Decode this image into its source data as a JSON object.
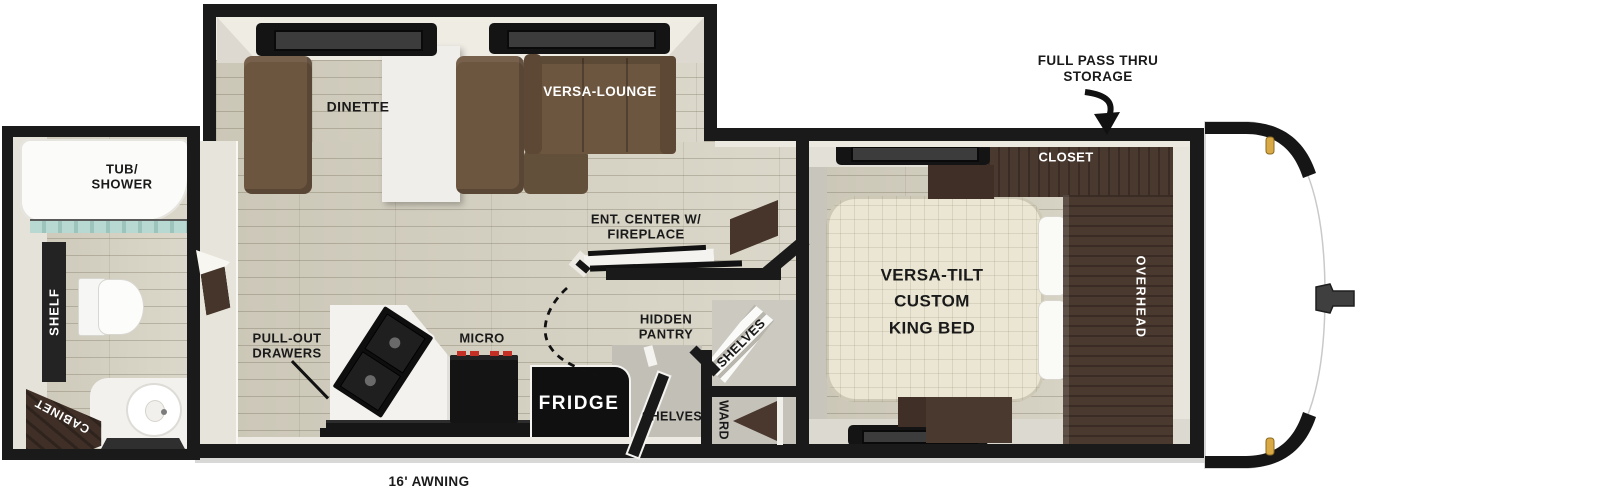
{
  "floorplan": {
    "type": "travel trailer floor plan",
    "awning_label": "16' AWNING",
    "exterior": {
      "storage_line1": "FULL PASS THRU",
      "storage_line2": "STORAGE"
    },
    "bathroom": {
      "tub_line1": "TUB/",
      "tub_line2": "SHOWER",
      "shelf": "SHELF",
      "cabinet": "CABINET"
    },
    "living": {
      "dinette": "DINETTE",
      "versa_lounge": "VERSA-LOUNGE",
      "ent_center_line1": "ENT. CENTER W/",
      "ent_center_line2": "FIREPLACE"
    },
    "kitchen": {
      "pullout_line1": "PULL-OUT",
      "pullout_line2": "DRAWERS",
      "micro": "MICRO",
      "fridge": "FRIDGE",
      "pantry_line1": "HIDDEN",
      "pantry_line2": "PANTRY",
      "shelves_corner": "SHELVES",
      "shelves_lower": "SHELVES",
      "ward": "WARD"
    },
    "bedroom": {
      "bed_line1": "VERSA-TILT",
      "bed_line2": "CUSTOM",
      "bed_line3": "KING BED",
      "closet": "CLOSET",
      "overhead": "OVERHEAD"
    }
  },
  "colors": {
    "wall": "#1a1a1a",
    "floor_tan": "#d7d3c4",
    "wood_dark": "#4a392f",
    "sofa_brown": "#6d5640",
    "bed_cream": "#eae6d3",
    "marker_amber": "#d9a945",
    "burner_red": "#c43025",
    "glass_teal": "#a9cfc7"
  }
}
